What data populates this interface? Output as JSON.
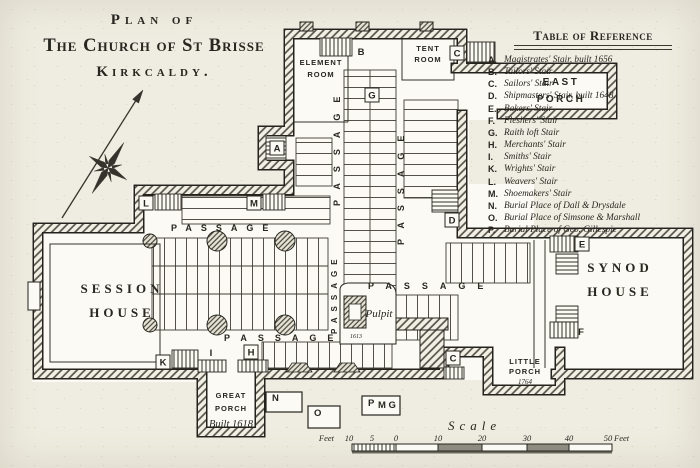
{
  "title": {
    "line1": "Plan of",
    "line2": "The Church of St Brisse",
    "line3": "Kirkcaldy."
  },
  "reference": {
    "title": "Table of Reference",
    "entries": [
      {
        "key": "A.",
        "label": "Magistrates' Stair, built 1656"
      },
      {
        "key": "B.",
        "label": "Tailors' Stair"
      },
      {
        "key": "C.",
        "label": "Sailors' Stair"
      },
      {
        "key": "D.",
        "label": "Shipmasters' Stair, built 1648."
      },
      {
        "key": "E.",
        "label": "Bakers' Stair"
      },
      {
        "key": "F.",
        "label": "Fleshers' Stair"
      },
      {
        "key": "G.",
        "label": "Raith loft Stair"
      },
      {
        "key": "H.",
        "label": "Merchants' Stair"
      },
      {
        "key": "I.",
        "label": "Smiths' Stair"
      },
      {
        "key": "K.",
        "label": "Wrights' Stair"
      },
      {
        "key": "L.",
        "label": "Weavers' Stair"
      },
      {
        "key": "M.",
        "label": "Shoemakers' Stair"
      },
      {
        "key": "N.",
        "label": "Burial Place of Dall & Drysdale"
      },
      {
        "key": "O.",
        "label": "Burial Place of Simsone & Marshall"
      },
      {
        "key": "P.",
        "label": "Burial Place of Geo. Gillespie"
      }
    ]
  },
  "plan": {
    "rooms": {
      "element_room_1": "ELEMENT",
      "element_room_2": "ROOM",
      "tent_room_1": "TENT",
      "tent_room_2": "ROOM",
      "east_porch_1": "EAST",
      "east_porch_2": "PORCH",
      "session_house_1": "SESSION",
      "session_house_2": "HOUSE",
      "synod_house_1": "SYNOD",
      "synod_house_2": "HOUSE",
      "little_porch_1": "LITTLE",
      "little_porch_2": "PORCH",
      "little_porch_year": "1764",
      "great_porch_1": "GREAT",
      "great_porch_2": "PORCH",
      "great_porch_year": "Built 1618",
      "pulpit": "Pulpit",
      "pulpit_year": "1613"
    },
    "passage": "PASSAGE",
    "stairs": {
      "a": "A",
      "b": "B",
      "c": "C",
      "d": "D",
      "e": "E",
      "f": "F",
      "g": "G",
      "h": "H",
      "i": "I",
      "k": "K",
      "l": "L",
      "m": "M"
    },
    "burials": {
      "n": "N",
      "o": "O",
      "p": "P",
      "p_sub": "M G"
    }
  },
  "scale": {
    "title": "Scale",
    "feet_left": "Feet",
    "feet_right": "Feet",
    "ticks": [
      "10",
      "5",
      "0",
      "10",
      "20",
      "30",
      "40",
      "50"
    ]
  },
  "colors": {
    "paper": "#efece1",
    "ink": "#27261f"
  }
}
